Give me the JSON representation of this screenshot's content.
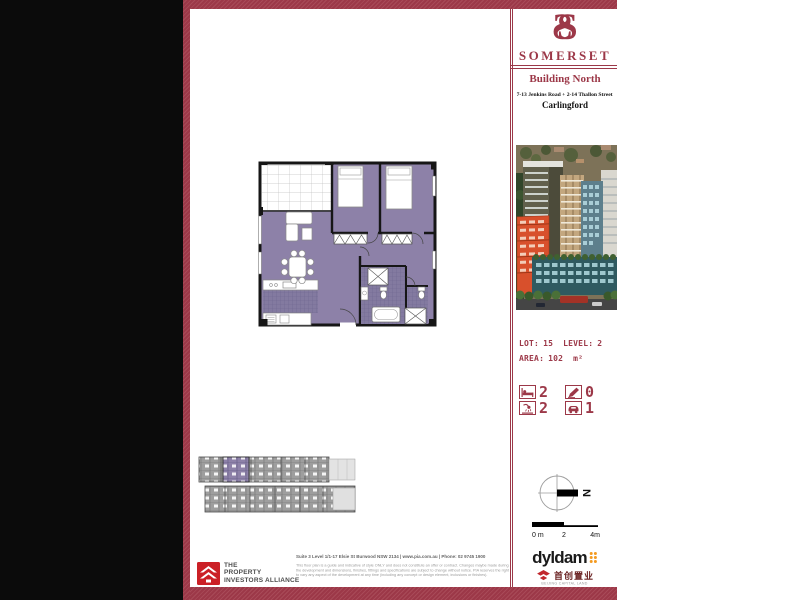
{
  "brand": {
    "monogram_left": "S",
    "monogram_right": "S",
    "name": "SOMERSET"
  },
  "header": {
    "building": "Building North",
    "address": "7-13 Jenkins Road + 2-14 Thallon Street",
    "suburb": "Carlingford"
  },
  "unit": {
    "lot_label": "LOT:",
    "lot": "15",
    "level_label": "LEVEL:",
    "level": "2",
    "area_label": "AREA:",
    "area": "102",
    "area_unit": "m²"
  },
  "features": [
    {
      "name": "bedrooms",
      "count": "2"
    },
    {
      "name": "study",
      "count": "0"
    },
    {
      "name": "bathrooms",
      "count": "2"
    },
    {
      "name": "car-spaces",
      "count": "1"
    }
  ],
  "compass": {
    "north": "N"
  },
  "scale_bar": {
    "start": "0 m",
    "mid": "2",
    "end": "4m"
  },
  "footer": {
    "pia_name_line1": "THE",
    "pia_name_line2": "PROPERTY",
    "pia_name_line3": "INVESTORS ALLIANCE",
    "contact": "Suite 3 Level 1/1-17 Elsie St Burwood NSW 2134 | www.pia.com.au | Phone: 02 9745 1900",
    "disclaimer_line1": "This floor plan is a guide and indicative of style ONLY and does not constitute an offer or contract. Changes maybe made during",
    "disclaimer_line2": "the development and dimensions, finishes, fittings and specifications are subject to change without notice. PIA reserves the right",
    "disclaimer_line3": "to vary any aspect of the development at any time (including any concept or design element, inclusions or finishes).",
    "developer": "dyldam",
    "partner_cn": "首创置业",
    "partner_en": "BEIJING CAPITAL LAND"
  },
  "colors": {
    "maroon": "#9c3848",
    "plan_purple": "#8d81a8",
    "dyldam_orange": "#f49a1f",
    "pia_red": "#cb2026"
  }
}
